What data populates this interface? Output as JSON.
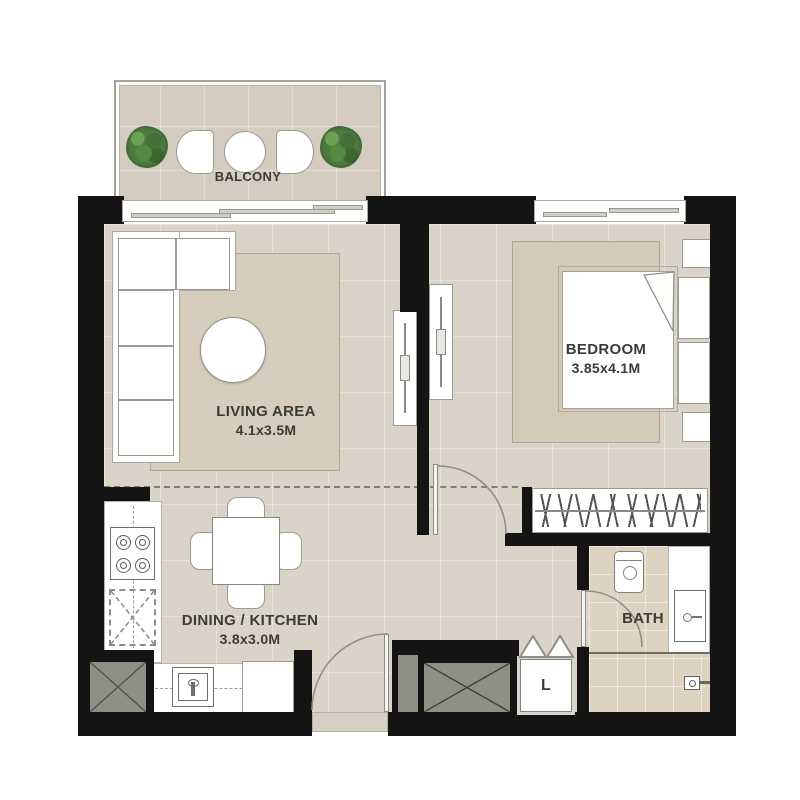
{
  "rooms": {
    "balcony": {
      "label": "BALCONY"
    },
    "living": {
      "label": "LIVING AREA",
      "dimensions": "4.1x3.5M"
    },
    "bedroom": {
      "label": "BEDROOM",
      "dimensions": "3.85x4.1M"
    },
    "dining": {
      "label": "DINING / KITCHEN",
      "dimensions": "3.8x3.0M"
    },
    "bath": {
      "label": "BATH"
    },
    "laundry": {
      "label": "L"
    }
  },
  "colors": {
    "wall": "#141414",
    "floor": "#dad3c8",
    "balcony_floor": "#d4ccbe",
    "bath_floor": "#ded3c1",
    "rug": "#d6ccba",
    "shaft_gray": "#8f8f86",
    "plant_green": "#4d7c3e",
    "line_gray": "#8f8f88",
    "text": "#3b3b35"
  }
}
